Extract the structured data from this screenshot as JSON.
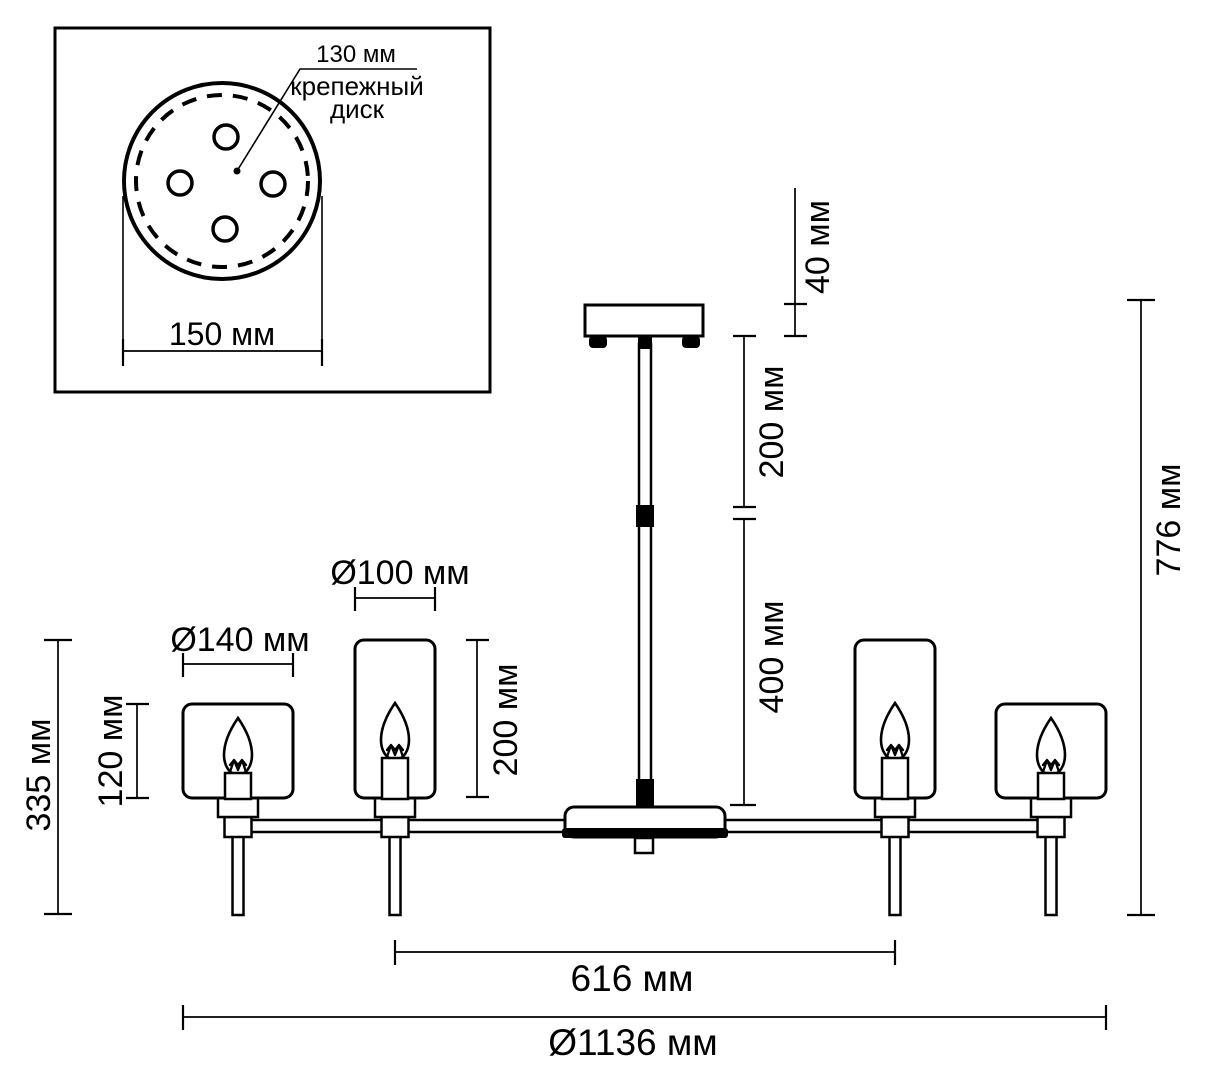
{
  "colors": {
    "line": "#000000",
    "background": "#ffffff"
  },
  "inset": {
    "bolt_circle_diameter": "130 мм",
    "mounting_disk_caption_line1": "крепежный",
    "mounting_disk_caption_line2": "диск",
    "plate_diameter": "150 мм"
  },
  "dimensions": {
    "canopy_height": "40 мм",
    "upper_rod_length": "200 мм",
    "lower_rod_length": "400 мм",
    "overall_height": "776 мм",
    "large_shade_diameter": "Ø140 мм",
    "small_shade_diameter": "Ø100 мм",
    "small_shade_height": "200 мм",
    "large_shade_height": "120 мм",
    "arm_to_tip_height": "335 мм",
    "inner_lamps_span": "616 мм",
    "overall_diameter": "Ø1136 мм"
  }
}
